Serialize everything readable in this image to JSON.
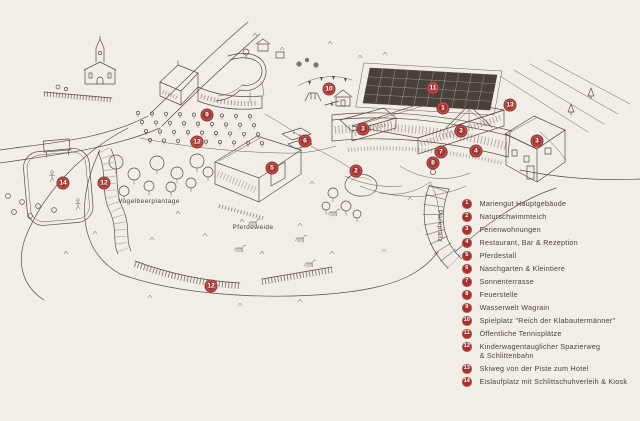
{
  "page": {
    "background": "#f2ede6"
  },
  "colors": {
    "marker_red": "#a23531",
    "line_ink": "#564e44",
    "text": "#4a433c",
    "court_dark": "#48413a"
  },
  "map": {
    "labels": {
      "vogelbeerplantage": "Vogelbeerplantage",
      "pferdeweide": "Pferdeweide",
      "parkplatz": "Parkplatz"
    },
    "markers": [
      {
        "num": "9",
        "x": 207,
        "y": 115
      },
      {
        "num": "10",
        "x": 329,
        "y": 89
      },
      {
        "num": "11",
        "x": 433,
        "y": 88
      },
      {
        "num": "1",
        "x": 443,
        "y": 108
      },
      {
        "num": "13",
        "x": 510,
        "y": 105
      },
      {
        "num": "3",
        "x": 363,
        "y": 129
      },
      {
        "num": "3",
        "x": 461,
        "y": 131
      },
      {
        "num": "3",
        "x": 537,
        "y": 141
      },
      {
        "num": "6",
        "x": 305,
        "y": 141
      },
      {
        "num": "12",
        "x": 197,
        "y": 142
      },
      {
        "num": "7",
        "x": 441,
        "y": 152
      },
      {
        "num": "4",
        "x": 476,
        "y": 151
      },
      {
        "num": "8",
        "x": 433,
        "y": 163
      },
      {
        "num": "2",
        "x": 356,
        "y": 171
      },
      {
        "num": "5",
        "x": 272,
        "y": 168
      },
      {
        "num": "14",
        "x": 63,
        "y": 183
      },
      {
        "num": "12",
        "x": 104,
        "y": 183
      },
      {
        "num": "12",
        "x": 211,
        "y": 286
      }
    ]
  },
  "legend": {
    "items": [
      {
        "num": "1",
        "label": "Mariengut Hauptgebäude"
      },
      {
        "num": "2",
        "label": "Naturschwimmteich"
      },
      {
        "num": "3",
        "label": "Ferienwohnungen"
      },
      {
        "num": "4",
        "label": "Restaurant, Bar & Rezeption"
      },
      {
        "num": "5",
        "label": "Pferdestall"
      },
      {
        "num": "6",
        "label": "Naschgarten & Kleintiere"
      },
      {
        "num": "7",
        "label": "Sonnenterrasse"
      },
      {
        "num": "8",
        "label": "Feuerstelle"
      },
      {
        "num": "9",
        "label": "Wasserwelt Wagrain"
      },
      {
        "num": "10",
        "label": "Spielplatz \"Reich der Klabautermänner\""
      },
      {
        "num": "11",
        "label": "Öffentliche Tennisplätze"
      },
      {
        "num": "12",
        "label": "Kinderwagentauglicher Spazierweg\n& Schlittenbahn"
      },
      {
        "num": "13",
        "label": "Skiweg von der Piste zum Hotel"
      },
      {
        "num": "14",
        "label": "Eislaufplatz mit Schlittschuhverleih & Kiosk"
      }
    ]
  }
}
